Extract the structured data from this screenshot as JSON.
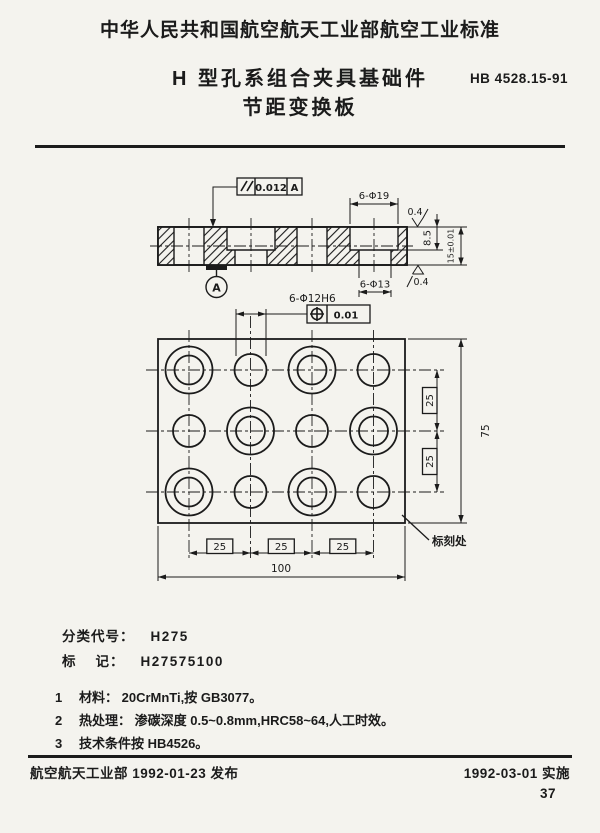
{
  "header": {
    "standard_org_line": "中华人民共和国航空航天工业部航空工业标准",
    "title_line1": "H 型孔系组合夹具基础件",
    "title_line2": "节距变换板",
    "standard_code": "HB 4528.15-91"
  },
  "drawing": {
    "parallelism": {
      "value": "0.012",
      "datum": "A"
    },
    "position": {
      "value": "0.01"
    },
    "dims": {
      "counterbore": "6-Φ19",
      "through_hole": "6-Φ13",
      "precision_hole": "6-Φ12H6",
      "counterbore_depth": "8.5",
      "thickness": "15±0.01",
      "pitch": "25",
      "total_width": "100",
      "total_height": "75"
    },
    "roughness": {
      "top": "0.4",
      "bottom": "0.4"
    },
    "datum_label": "A",
    "marking_note": "标刻处"
  },
  "identification": {
    "class_label": "分类代号：",
    "class_value": "H275",
    "mark_label": "标    记：",
    "mark_value": "H27575100"
  },
  "notes": [
    {
      "num": "1",
      "text": "材料： 20CrMnTi,按 GB3077。"
    },
    {
      "num": "2",
      "text": "热处理： 渗碳深度 0.5~0.8mm,HRC58~64,人工时效。"
    },
    {
      "num": "3",
      "text": "技术条件按 HB4526。"
    }
  ],
  "footer": {
    "left": "航空航天工业部 1992-01-23 发布",
    "right": "1992-03-01 实施",
    "page_number": "37"
  }
}
